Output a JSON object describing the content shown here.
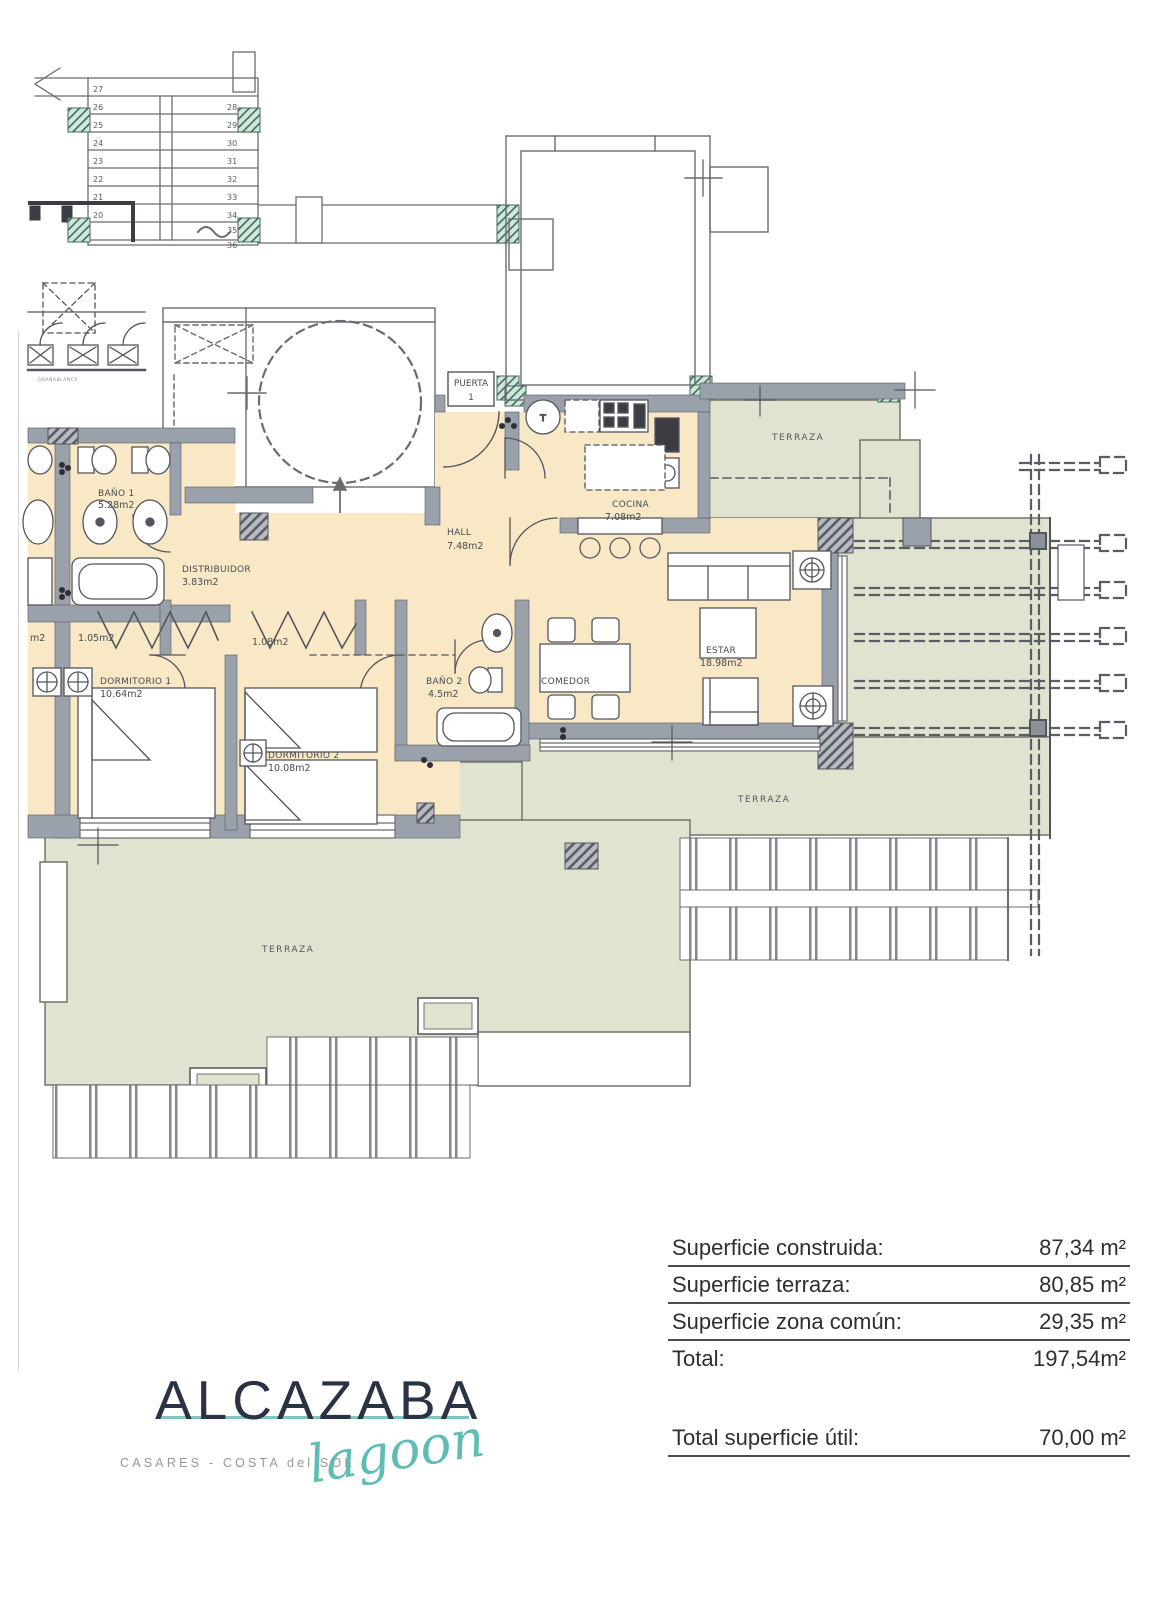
{
  "plan": {
    "stairs": {
      "left": [
        "27",
        "26",
        "25",
        "24",
        "23",
        "22",
        "21",
        "20"
      ],
      "right": [
        "28",
        "29",
        "30",
        "31",
        "32",
        "33",
        "34",
        "35",
        "36"
      ]
    },
    "entry": {
      "line1": "PUERTA",
      "line2": "1"
    },
    "micro_label": "GRANABLANCA",
    "kitchen_mark": "T",
    "rooms": {
      "bano1": {
        "name": "BAÑO 1",
        "area": "5.28m2"
      },
      "distribuidor": {
        "name": "DISTRIBUIDOR",
        "area": "3.83m2"
      },
      "hall": {
        "name": "HALL",
        "area": "7.48m2"
      },
      "cocina": {
        "name": "COCINA",
        "area": "7.08m2"
      },
      "estar": {
        "name": "ESTAR",
        "area": "18.98m2"
      },
      "comedor": {
        "name": "COMEDOR"
      },
      "dorm1": {
        "name": "DORMITORIO 1",
        "area": "10.64m2"
      },
      "dorm2": {
        "name": "DORMITORIO 2",
        "area": "10.08m2"
      },
      "bano2": {
        "name": "BAÑO 2",
        "area": "4.5m2"
      },
      "closet1": {
        "area": "1.05m2"
      },
      "closet2": {
        "area": "1.08m2"
      },
      "closet_partial": {
        "area": "m2"
      }
    },
    "terrazas": {
      "top": "TERRAZA",
      "mid": "TERRAZA",
      "bottom": "TERRAZA"
    }
  },
  "summary": {
    "rows": [
      {
        "label": "Superficie construida:",
        "value": "87,34 m²"
      },
      {
        "label": "Superficie terraza:",
        "value": "80,85 m²"
      },
      {
        "label": "Superficie zona común:",
        "value": "29,35 m²"
      },
      {
        "label": "Total:",
        "value": "197,54m²"
      }
    ],
    "total_util": {
      "label": "Total superficie útil:",
      "value": "70,00 m²"
    }
  },
  "logo": {
    "brand": "ALCAZABA",
    "script": "lagoon",
    "subtitle": "CASARES - COSTA del SOL"
  },
  "colors": {
    "room_fill": "#f8e8c5",
    "terrace_fill": "#e0e3d0",
    "wall_fill": "#9aa1ab",
    "line": "#54555e",
    "column_fill": "#cdE9dc",
    "logo_navy": "#2a3343",
    "logo_teal": "#5fbdb5",
    "subtitle_gray": "#97989a",
    "table_text": "#2f2f31"
  }
}
